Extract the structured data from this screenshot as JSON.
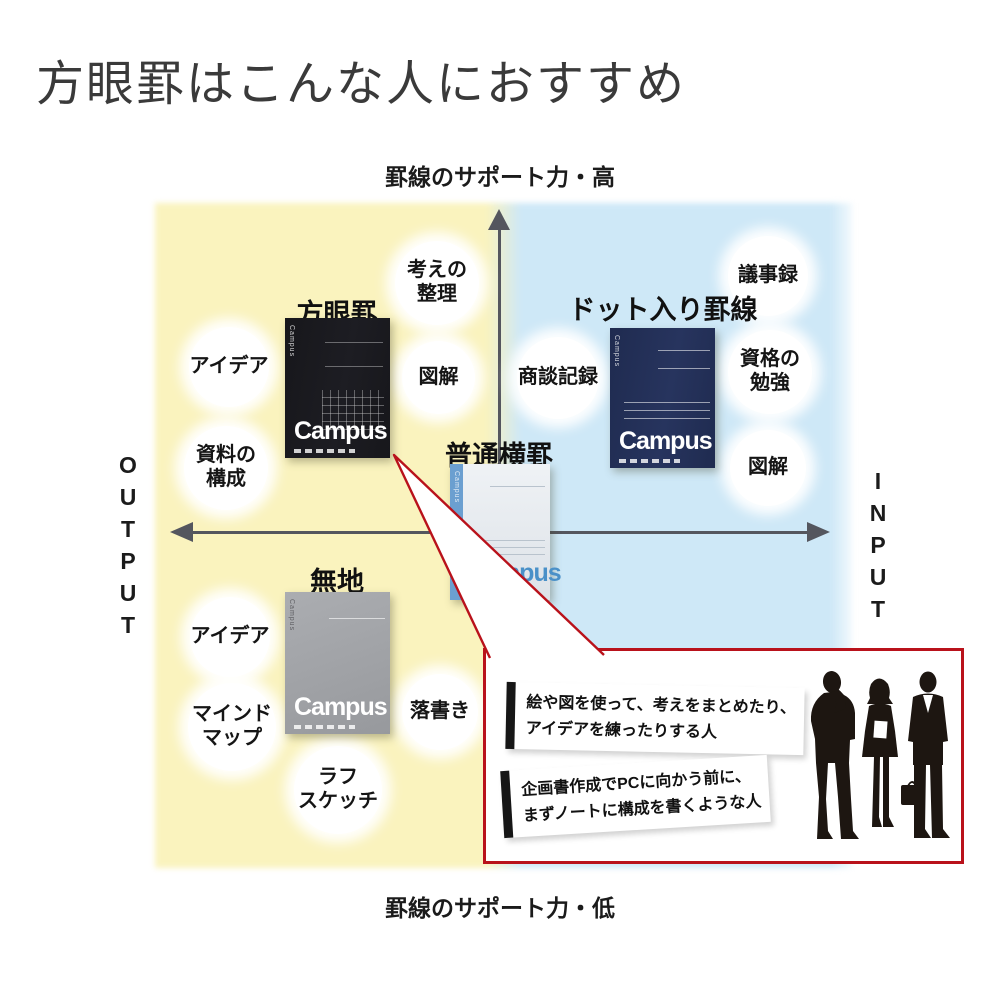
{
  "title": "方眼罫はこんな人におすすめ",
  "axis": {
    "top_label": "罫線のサポート力・高",
    "bottom_label": "罫線のサポート力・低",
    "left_label": "OUTPUT",
    "right_label": "INPUT"
  },
  "colors": {
    "left_quadrant": "#FAF3BE",
    "right_quadrant": "#CEE8F7",
    "axis_arrow": "#54565E",
    "callout_border": "#B9121B",
    "grid_notebook_cover": "#1A1A1F",
    "dot_notebook_cover": "#232F55",
    "normal_notebook_cover": "#E9EDF2",
    "plain_notebook_cover": "#A0A2A6"
  },
  "notebooks": {
    "grid": {
      "label": "方眼罫",
      "logo": "Campus"
    },
    "dot": {
      "label": "ドット入り罫線",
      "logo": "Campus"
    },
    "normal": {
      "label": "普通横罫",
      "logo": "Campus"
    },
    "plain": {
      "label": "無地",
      "logo": "Campus"
    }
  },
  "bubbles": [
    {
      "lines": [
        "考えの",
        "整理"
      ]
    },
    {
      "lines": [
        "アイデア"
      ]
    },
    {
      "lines": [
        "図解"
      ]
    },
    {
      "lines": [
        "資料の",
        "構成"
      ]
    },
    {
      "lines": [
        "議事録"
      ]
    },
    {
      "lines": [
        "商談記録"
      ]
    },
    {
      "lines": [
        "資格の",
        "勉強"
      ]
    },
    {
      "lines": [
        "図解"
      ]
    },
    {
      "lines": [
        "アイデア"
      ]
    },
    {
      "lines": [
        "マインド",
        "マップ"
      ]
    },
    {
      "lines": [
        "ラフ",
        "スケッチ"
      ]
    },
    {
      "lines": [
        "落書き"
      ]
    }
  ],
  "callout": {
    "illustration": "business-people-silhouette",
    "panels": [
      {
        "lines": [
          "絵や図を使って、考えをまとめたり、",
          "アイデアを練ったりする人"
        ]
      },
      {
        "lines": [
          "企画書作成でPCに向かう前に、",
          "まずノートに構成を書くような人"
        ]
      }
    ]
  }
}
